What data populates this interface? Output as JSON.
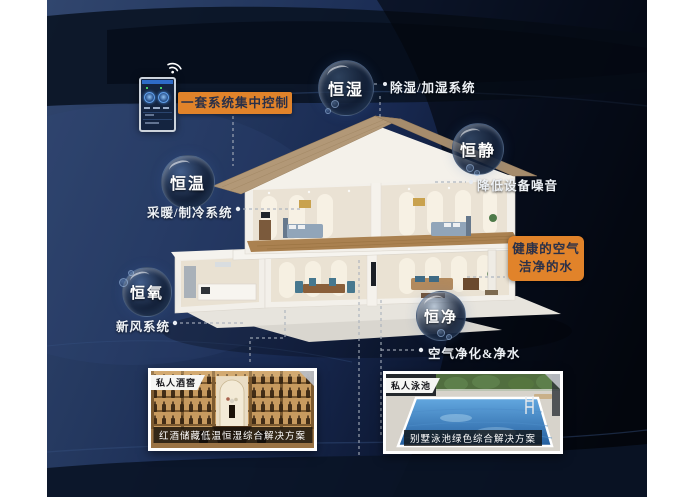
{
  "control_label": "一套系统集中控制",
  "highlight": {
    "line1": "健康的空气",
    "line2": "洁净的水"
  },
  "systems": [
    {
      "name": "恒湿",
      "annotation": "除湿/加湿系统"
    },
    {
      "name": "恒静",
      "annotation": "降低设备噪音"
    },
    {
      "name": "恒温",
      "annotation": "采暖/制冷系统"
    },
    {
      "name": "恒氧",
      "annotation": "新风系统"
    },
    {
      "name": "恒净",
      "annotation": "空气净化&净水"
    }
  ],
  "cards": [
    {
      "tag": "私人酒窖",
      "caption": "红酒储藏低温恒湿综合解决方案"
    },
    {
      "tag": "私人泳池",
      "caption": "别墅泳池绿色综合解决方案"
    }
  ],
  "colors": {
    "accent_orange": "#E1832A",
    "background_navy": "#1E3053",
    "annotation_text": "#EDF1F6"
  }
}
